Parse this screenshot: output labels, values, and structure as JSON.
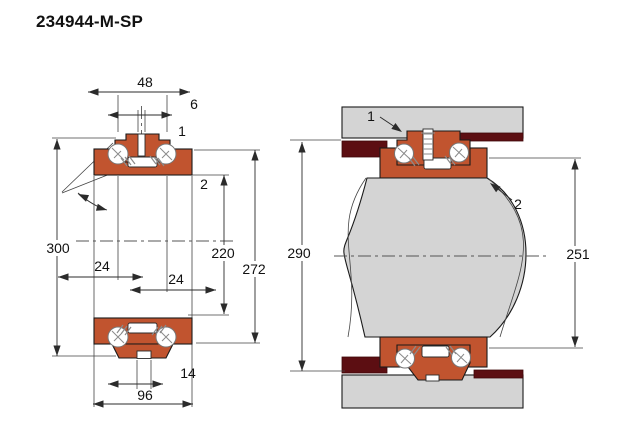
{
  "title": "234944-M-SP",
  "colors": {
    "bearing_orange": "#c1542f",
    "housing_gray": "#d4d4d4",
    "spacer_maroon": "#5c0e12",
    "outline": "#1a1a1a",
    "dimension_line": "#2b2b2b",
    "background": "#ffffff"
  },
  "left_figure": {
    "caption": "bearing-cross-section",
    "dims": {
      "top_width": "48",
      "top_slot": "6",
      "outer_diameter": "300",
      "bore_diameter": "220",
      "washer_outer_diameter": "272",
      "row_offset_left": "24",
      "row_offset_right": "24",
      "bottom_slot": "14",
      "overall_width": "96"
    },
    "callouts": {
      "one": "1",
      "two": "2"
    }
  },
  "right_figure": {
    "caption": "mounted-bearing-arrangement",
    "dims": {
      "housing_shoulder_diameter": "290",
      "shaft_shoulder_diameter": "251"
    },
    "callouts": {
      "one": "1",
      "two": "2"
    }
  }
}
